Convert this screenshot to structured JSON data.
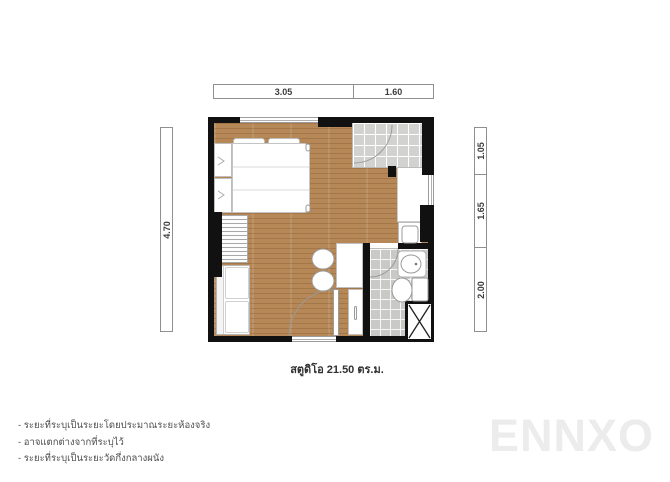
{
  "plan": {
    "caption": "สตูดิโอ 21.50 ตร.ม.",
    "dimensions": {
      "top": [
        "3.05",
        "1.60"
      ],
      "left": [
        "4.70"
      ],
      "right": [
        "1.05",
        "1.65",
        "2.00"
      ]
    },
    "rooms": [
      "bedroom-living-area",
      "entry-foyer",
      "bathroom"
    ],
    "fixtures": [
      "bed",
      "pillows",
      "wardrobe",
      "shelf-unit",
      "sofa",
      "kitchen-counter",
      "stools",
      "tall-cabinet",
      "washing-machine",
      "sink",
      "toilet",
      "service-shaft",
      "entrance-door",
      "bathroom-door",
      "balcony-door",
      "window"
    ],
    "colors": {
      "wood_floor": "#b68757",
      "entry_tile": "#d2d2d0",
      "bath_tile": "#c9c9c7",
      "wall": "#111111",
      "furniture_outline": "#bdbdbd"
    }
  },
  "footnotes": [
    "- ระยะที่ระบุเป็นระยะโดยประมาณระยะห้องจริง",
    "- อาจแตกต่างจากที่ระบุไว้",
    "- ระยะที่ระบุเป็นระยะวัดกึ่งกลางผนัง"
  ],
  "watermark": "ENNXO"
}
